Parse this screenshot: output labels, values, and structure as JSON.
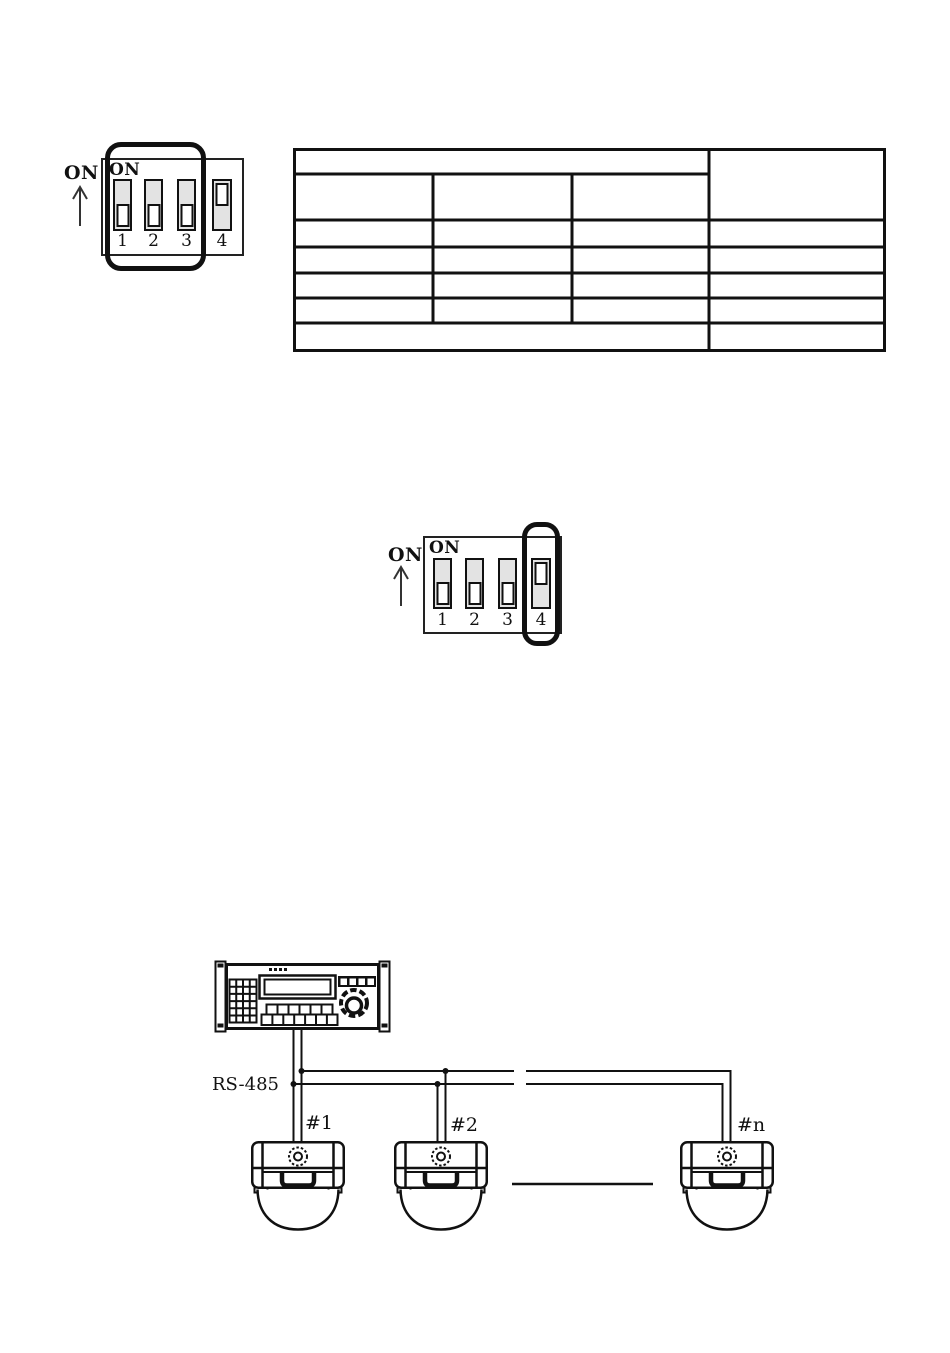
{
  "dip_switch_diagram_1": {
    "direction_label": "ON",
    "panel_label": "ON",
    "switches": [
      {
        "number": "1",
        "state": "off"
      },
      {
        "number": "2",
        "state": "off"
      },
      {
        "number": "3",
        "state": "off"
      },
      {
        "number": "4",
        "state": "on"
      }
    ],
    "highlighted_switches": "1-3"
  },
  "dip_switch_diagram_2": {
    "direction_label": "ON",
    "panel_label": "ON",
    "switches": [
      {
        "number": "1",
        "state": "off"
      },
      {
        "number": "2",
        "state": "off"
      },
      {
        "number": "3",
        "state": "off"
      },
      {
        "number": "4",
        "state": "on"
      }
    ],
    "highlighted_switches": "4"
  },
  "settings_table": {
    "rows": 7,
    "columns": 4,
    "cells": "empty"
  },
  "wiring_diagram": {
    "bus_label": "RS-485",
    "camera_labels": [
      "#1",
      "#2",
      "#n"
    ]
  },
  "colors": {
    "ink": "#111111",
    "switch_fill": "#e3e3e3",
    "page_background": "#ffffff"
  }
}
